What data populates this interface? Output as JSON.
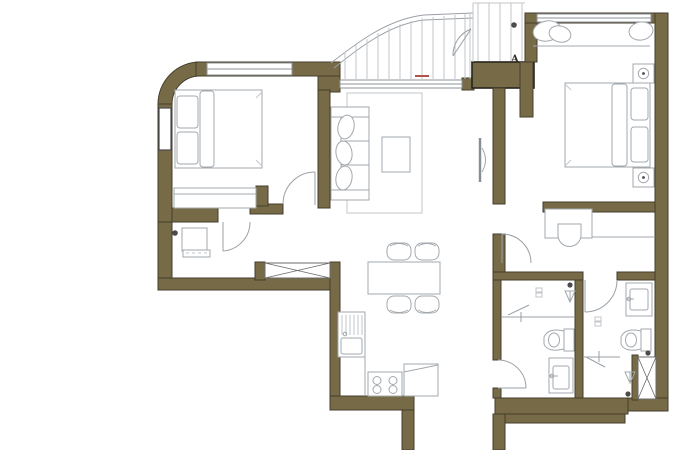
{
  "plan": {
    "title": "two-bedroom apartment floor plan",
    "marker_label": "A"
  },
  "colors": {
    "background": "#ffffff",
    "wall": "#776b47",
    "wall_edge": "#453d2b",
    "block_edge": "#26231c",
    "window_line": "#8d9399",
    "furniture_line": "#a3a8ae",
    "light_line": "#c3c6ca",
    "door_line": "#9aa0a6",
    "dark_dot": "#4b4b4b",
    "accent_red": "#b3524a",
    "section_window_edge": "#4a4a4a"
  },
  "fixtures": [
    "double-bed-left",
    "wardrobe-dresser",
    "entry-console",
    "entry-closet",
    "sofa",
    "rug",
    "coffee-table",
    "tv",
    "dining-table",
    "dining-chairs",
    "kitchen-sink",
    "stove",
    "fridge",
    "balcony-decking",
    "balcony-door",
    "window-seat",
    "double-bed-right",
    "nightstand-lamps",
    "desk",
    "desk-chair",
    "toilet-1",
    "toilet-2",
    "washbasin-1",
    "washbasin-2",
    "shower-head-1",
    "shower-head-2",
    "service-shaft",
    "windows",
    "doors"
  ]
}
